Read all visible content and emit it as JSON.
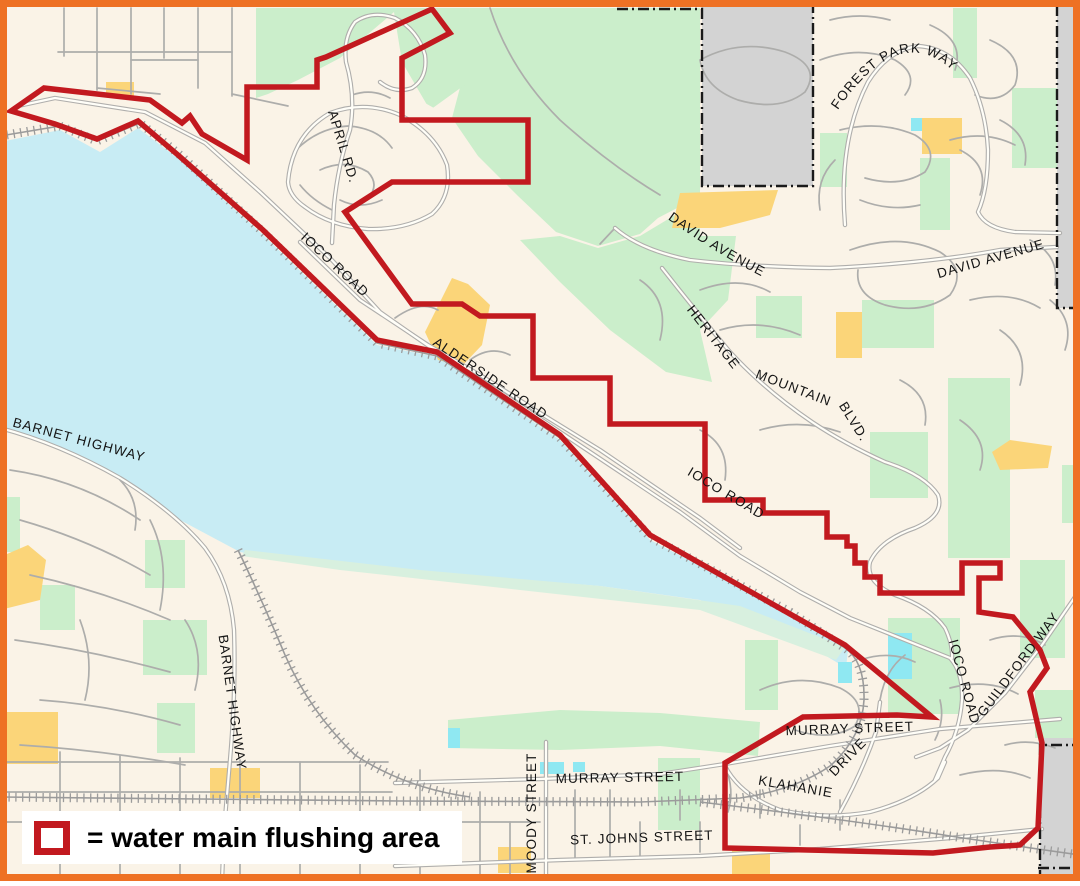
{
  "page": {
    "description": "Street map with water main flushing area outlined in red"
  },
  "legend": {
    "label": "= water main flushing area",
    "swatch_color": "#C2191F"
  },
  "colors": {
    "frame": "#EE7124",
    "land": "#FAF3E7",
    "water": "#C8ECF4",
    "marsh": "#D8F0DF",
    "green": "#CBEECB",
    "yellow": "#FBD579",
    "gray_area": "#D3D3D3",
    "cream": "#FAF3E7",
    "road_casing": "#AFAEAC",
    "road_fill": "#FFFEF8",
    "minor_road": "#ADADAB",
    "rail": "#9B9B9B",
    "pond": "#8FE8F2",
    "boundary_red": "#C2191F",
    "boundary_black": "#1A1A1A",
    "label_color": "#141414"
  },
  "streets": [
    {
      "name": "APRIL RD.",
      "x": 339,
      "y": 148,
      "rotate": 73
    },
    {
      "name": "IOCO ROAD",
      "x": 332,
      "y": 268,
      "rotate": 43
    },
    {
      "name": "ALDERSIDE ROAD",
      "x": 488,
      "y": 382,
      "rotate": 34
    },
    {
      "name": "IOCO ROAD",
      "x": 724,
      "y": 497,
      "rotate": 31
    },
    {
      "name": "BARNET HIGHWAY",
      "x": 78,
      "y": 444,
      "rotate": 15
    },
    {
      "name": "BARNET HIGHWAY",
      "x": 228,
      "y": 703,
      "rotate": 82
    },
    {
      "name": "DAVID AVENUE",
      "x": 992,
      "y": 263,
      "rotate": -16
    },
    {
      "name": "HERITAGE",
      "x": 710,
      "y": 340,
      "rotate": 52
    },
    {
      "name": "MOUNTAIN",
      "x": 792,
      "y": 392,
      "rotate": 21
    },
    {
      "name": "BLVD.",
      "x": 850,
      "y": 424,
      "rotate": 58
    },
    {
      "name": "MURRAY STREET",
      "x": 850,
      "y": 733,
      "rotate": -2
    },
    {
      "name": "KLAHANIE",
      "x": 795,
      "y": 791,
      "rotate": 10
    },
    {
      "name": "DRIVE",
      "x": 851,
      "y": 760,
      "rotate": -46
    },
    {
      "name": "MURRAY STREET",
      "x": 620,
      "y": 782,
      "rotate": -1
    },
    {
      "name": "MOODY STREET",
      "x": 536,
      "y": 813,
      "rotate": -90
    },
    {
      "name": "ST. JOHNS STREET",
      "x": 642,
      "y": 842,
      "rotate": -2
    },
    {
      "name": "IOCO ROAD",
      "x": 960,
      "y": 683,
      "rotate": 75
    },
    {
      "name": "GUILDFORD WAY",
      "x": 1022,
      "y": 667,
      "rotate": -53
    }
  ],
  "curved_streets": [
    {
      "name": "FOREST PARK WAY",
      "path": "M834,116 Q900,14 958,76"
    },
    {
      "name": "DAVID AVENUE",
      "path": "M650,206 Q716,256 782,286"
    }
  ],
  "geometry": {
    "water": [
      "M0,142 L60,130 L100,152 L138,128 L180,160 L263,235 L377,345 L437,357 L560,440 L650,540 L790,612 L848,650 L846,668 L800,640 L700,600 L600,586 L500,578 L400,572 L310,565 L240,552 L180,520 L120,478 L60,448 L0,430 Z"
    ],
    "marsh": [
      "M245,550 L420,570 L600,586 L740,606 L845,647 L836,660 L700,610 L520,590 L340,570 L242,556 Z"
    ],
    "green": [
      "M470,8 L700,8 L700,196 L658,218 L640,234 L598,246 L556,232 L518,196 L478,156 L452,118 L462,80 Z",
      "M256,8 L470,8 L466,84 L430,110 L402,62 L394,12 L340,58 L298,80 L268,94 L256,98 Z",
      "M560,236 L598,248 L640,236 L700,200 L700,236 L736,236 L728,300 L700,330 L712,382 L666,372 L610,330 L560,282 L520,240 Z",
      "M756,296 h46 v42 h-46 Z",
      "M862,300 h72 v48 h-72 Z",
      "M948,378 h62 v180 h-62 Z",
      "M870,432 h58 v66 h-58 Z",
      "M1020,560 h45 v98 h-45 Z",
      "M888,618 h72 v96 h-72 Z",
      "M745,640 h33 v70 h-33 Z",
      "M953,8 h24 v70 h-24 Z",
      "M1012,88 h50 v80 h-50 Z",
      "M820,133 h27 v54 h-27 Z",
      "M920,158 h30 v72 h-30 Z",
      "M1062,465 h18 v58 h-18 Z",
      "M1035,690 h43 v48 h-43 Z",
      "M143,620 h64 v55 h-64 Z",
      "M157,703 h38 v50 h-38 Z",
      "M0,497 h20 v55 h-20 Z",
      "M40,585 h35 v45 h-35 Z",
      "M145,540 h40 v48 h-40 Z",
      "M658,758 h42 v72 h-42 Z",
      "M448,720 L560,710 L660,713 L760,722 L758,756 L660,746 L560,750 L448,748 Z"
    ],
    "cream_patches": [
      "M268,150 Q272,118 292,104 Q318,88 362,86 Q408,90 440,112 Q462,132 462,162 Q460,196 432,215 Q398,231 348,231 Q302,226 280,200 Q268,182 268,150 Z"
    ],
    "yellow": [
      "M106,82 h28 v14 h-28 Z",
      "M425,332 L452,278 L468,284 L490,305 L482,345 L462,366 L438,360 Z",
      "M672,228 L680,193 L778,190 L770,215 L720,228 Z",
      "M836,312 h26 v46 h-26 Z",
      "M992,452 L1010,440 L1052,446 L1048,468 L1000,470 Z",
      "M922,118 h40 v36 h-40 Z",
      "M0,557 L28,545 L46,560 L40,600 L0,610 Z",
      "M0,712 h58 v52 h-58 Z",
      "M498,847 h33 v26 h-33 Z",
      "M732,850 h38 v25 h-38 Z",
      "M210,768 h50 v30 h-50 Z"
    ],
    "gray": [
      "M702,0 H813 V186 H702 Z",
      "M1057,0 H1080 V308 H1057 Z",
      "M1040,738 H1080 V881 H1040 Z"
    ],
    "ponds": [
      "M888,633 h24 v46 h-24 Z",
      "M838,662 h14 v21 h-14 Z",
      "M911,118 h11 v13 h-11 Z",
      "M540,762 h24 v12 h-24 Z",
      "M448,728 h12 v20 h-12 Z",
      "M573,762 h12 v10 h-12 Z"
    ],
    "minor_roads": [
      "M64,8 V56",
      "M97,8 V90",
      "M131,8 V94",
      "M164,8 V58",
      "M198,8 V88",
      "M232,8 V96",
      "M58,52 H232",
      "M97,88 L160,94",
      "M232,94 L288,106",
      "M131,60 H198",
      "M10,470 Q80,480 140,520",
      "M20,520 Q90,540 150,575",
      "M30,575 Q100,590 170,620",
      "M15,640 Q90,650 170,672",
      "M40,700 Q110,705 180,725",
      "M20,745 Q100,750 185,765",
      "M150,520 Q170,560 160,610",
      "M80,620 Q95,660 85,700",
      "M185,620 Q205,650 195,690",
      "M120,480 Q140,500 135,530",
      "M0,762 H388",
      "M0,792 H392",
      "M0,822 H540",
      "M60,752 V881",
      "M120,756 V881",
      "M180,758 V881",
      "M240,760 V881",
      "M300,762 V881",
      "M360,765 V881",
      "M420,770 V881",
      "M480,792 V881",
      "M510,822 V881",
      "M575,790 V858",
      "M610,790 V858",
      "M640,822 V856",
      "M680,790 V820",
      "M700,822 V852",
      "M760,790 V818",
      "M800,825 V845",
      "M840,800 V830",
      "M296,150 Q318,128 348,126 Q378,128 392,148",
      "M320,170 Q345,158 368,172 Q380,185 368,198",
      "M340,200 Q360,210 382,200",
      "M352,95 Q372,88 390,98",
      "M300,185 Q312,200 332,210",
      "M490,8 Q510,70 560,120 Q610,165 660,195",
      "M700,60 Q740,38 785,52 Q822,66 805,92 Q780,112 738,100 Q705,88 700,60",
      "M820,60 Q860,45 895,60 Q920,75 905,95",
      "M930,25 Q965,40 955,70",
      "M990,40 Q1025,55 1015,85 Q1000,105 975,95",
      "M840,130 Q880,120 915,135 Q940,150 925,172 Q900,188 865,178",
      "M950,140 Q985,130 1015,145",
      "M700,290 Q740,275 770,292",
      "M720,330 Q760,318 800,335",
      "M760,430 Q800,418 840,432",
      "M700,430 Q730,445 725,480",
      "M640,280 Q670,300 660,340",
      "M850,250 Q900,232 940,252 Q968,270 950,295 Q922,315 885,305 Q855,295 858,270",
      "M970,300 Q1010,290 1040,308",
      "M1000,330 Q1030,350 1020,385",
      "M960,420 Q990,440 980,470",
      "M900,380 Q930,395 925,425",
      "M1030,240 Q1060,255 1055,285",
      "M1050,300 Q1075,320 1065,350",
      "M760,690 Q800,672 840,688 Q868,702 855,726 Q830,742 795,730",
      "M950,688 Q988,678 1018,694",
      "M960,775 Q1000,765 1030,778",
      "M990,640 Q1020,630 1045,645",
      "M860,660 Q890,650 915,662",
      "M940,700 Q945,720 935,740",
      "M1005,745 Q1030,738 1055,748",
      "M830,20 Q860,12 890,20",
      "M960,150 Q990,165 980,195",
      "M1000,120 Q1030,135 1025,165",
      "M860,200 Q890,212 920,205",
      "M835,160 Q815,180 820,210",
      "M395,318 Q420,300 438,310",
      "M470,360 Q490,345 510,355",
      "M725,766 Q735,790 728,812",
      "M880,700 Q885,670 905,655",
      "M600,244 L615,228"
    ],
    "major_roads": [
      "M18,106 L55,98 L145,112 L205,143 L260,192 L330,258 L380,312 L437,352 L500,392 L560,432 L620,472 L680,512 L740,556 L800,592 L850,618 L950,658 Q963,672 962,700 Q960,730 945,757 L935,780",
      "M300,242 L360,300 L428,345 L480,375 L540,413 L600,450 L650,484 L700,518 L740,548",
      "M288,182 Q292,135 330,113 Q365,100 400,115 Q435,133 447,165 Q452,196 432,214 Q405,230 368,229 Q330,226 305,207 Q289,196 288,182",
      "M332,243 L334,205 Q338,165 350,130 Q356,96 346,62 Q343,38 355,22 Q372,10 395,18 Q418,30 425,55 Q428,78 412,88 Q395,94 380,82",
      "M615,228 Q640,250 690,260 Q750,267 830,268 Q930,263 1000,250 L1057,247",
      "M662,268 Q695,310 730,352 Q765,390 812,422 Q845,444 885,462 Q925,475 938,495 Q945,515 915,528 Q880,540 870,562 Q865,582 895,595 Q930,607 945,628 Q953,645 952,658",
      "M845,225 Q838,140 868,82 Q888,50 918,46 Q950,48 970,78 Q986,110 988,150 Q988,190 978,212 Q985,228 1015,232 L1060,233",
      "M0,428 Q60,444 120,478 Q175,512 205,548 Q230,582 234,630 Q236,690 230,760 L224,830 L222,881",
      "M395,783 L540,779 L660,774 L725,764 L830,746 L940,729 L1060,719",
      "M395,866 L560,860 L700,856 L820,849 L950,838 L1042,829",
      "M546,742 L546,881",
      "M1075,597 L1042,645 L1005,693 L968,730 L940,748 L916,757",
      "M725,766 Q740,795 780,810 Q825,820 870,812 Q915,800 938,778 L945,762",
      "M840,812 Q862,772 876,732 L880,702"
    ],
    "rails": [
      "M0,136 L60,126 L97,141 L140,123 L180,155 L263,232 L377,343 L437,356 L560,438 L650,537 L790,612 L845,648 Q865,662 864,700 Q862,738 830,766 Q795,790 740,798 L640,802 L400,801 L200,799 L0,797",
      "M238,550 Q262,600 285,655 Q310,712 355,755 Q405,788 470,797",
      "M700,802 Q850,820 950,836 Q1030,848 1080,855"
    ],
    "dash_boundaries": [
      "M617,9 H702 V186 H813 V0",
      "M1057,5 V308 H1080",
      "M1040,881 V745 H1080",
      "M1038,868 H1080"
    ],
    "red_boundary": "M11,111 L44,88 L150,100 L182,123 L190,116 L202,134 L247,160 L247,87 L317,87 L317,60 L326,57 L432,9 L450,33 L402,58 L402,120 L528,120 L528,182 L392,182 L345,212 L412,304 L462,304 L480,316 L533,316 L533,378 L610,378 L610,424 L705,424 L705,500 L763,500 L763,513 L827,513 L827,537 L847,537 L847,546 L855,546 L855,563 L865,563 L865,577 L880,577 L880,593 L962,593 L962,563 L1000,563 L1000,578 L979,578 L979,612 L1013,617 L1040,650 L1047,668 L1030,692 L1042,743 L1038,828 L1020,845 L990,847 L933,853 L725,848 L725,763 L803,717 L897,715 L932,717 L845,645 L650,535 L560,435 L437,352 L377,340 L263,230 L178,155 L138,121 L97,139 L55,124 Z"
  }
}
